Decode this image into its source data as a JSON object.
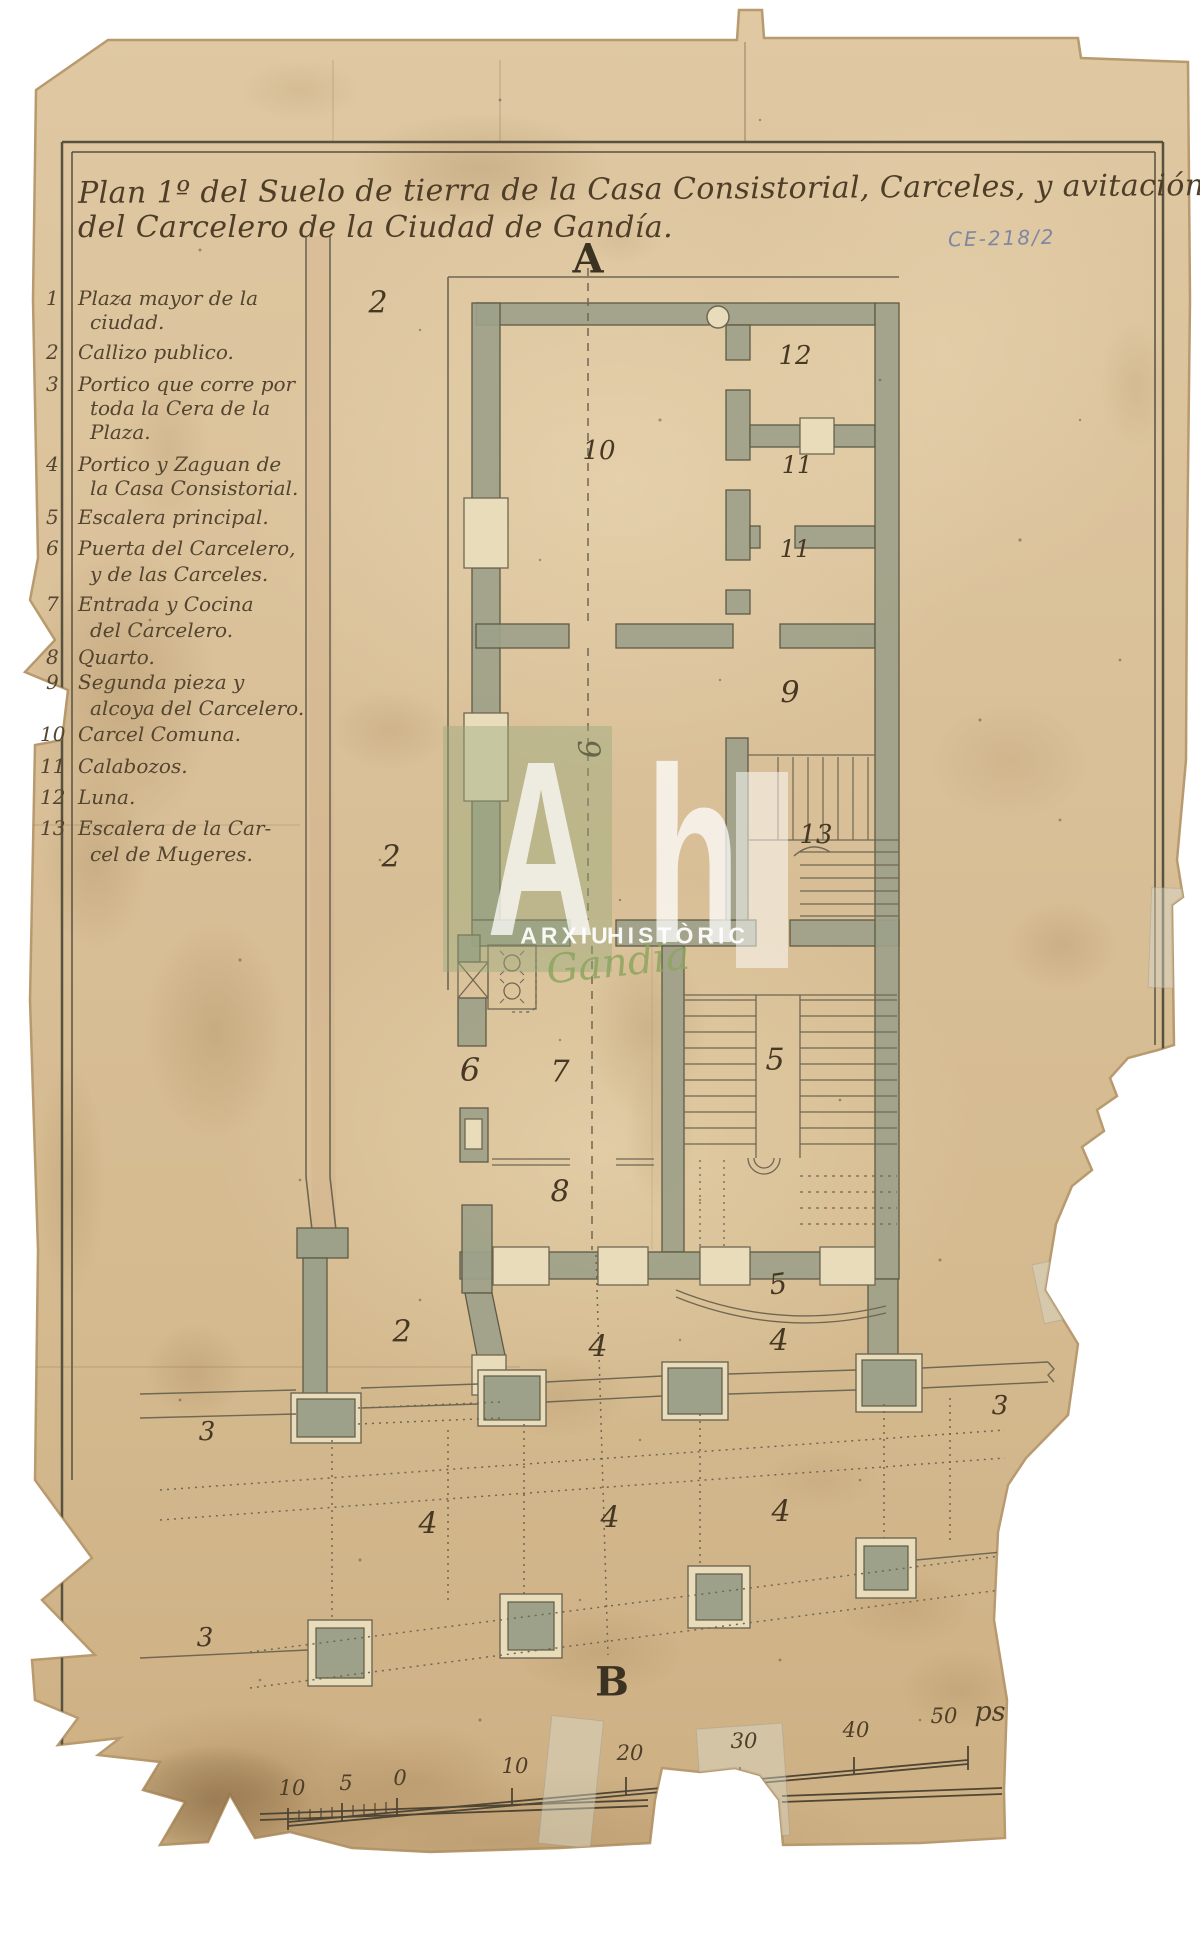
{
  "document": {
    "archive_reference": "CE-218/2",
    "title_line1": "Plan 1º del Suelo de tierra de la Casa Consistorial, Carceles, y avitación",
    "title_line2": "del Carcelero de la Ciudad de Gandía.",
    "type": "historic floor plan manuscript"
  },
  "legend": {
    "items": [
      {
        "num": "1",
        "lines": [
          {
            "text": "Plaza mayor de la",
            "y": 286
          },
          {
            "text": "ciudad.",
            "y": 310
          }
        ]
      },
      {
        "num": "2",
        "lines": [
          {
            "text": "Callizo publico.",
            "y": 340
          }
        ]
      },
      {
        "num": "3",
        "lines": [
          {
            "text": "Portico que corre por",
            "y": 372
          },
          {
            "text": "toda la Cera de la",
            "y": 396
          },
          {
            "text": "Plaza.",
            "y": 420
          }
        ]
      },
      {
        "num": "4",
        "lines": [
          {
            "text": "Portico y Zaguan de",
            "y": 452
          },
          {
            "text": "la Casa Consistorial.",
            "y": 476
          }
        ]
      },
      {
        "num": "5",
        "lines": [
          {
            "text": "Escalera principal.",
            "y": 505
          }
        ]
      },
      {
        "num": "6",
        "lines": [
          {
            "text": "Puerta del Carcelero,",
            "y": 536
          },
          {
            "text": "y de las Carceles.",
            "y": 562
          }
        ]
      },
      {
        "num": "7",
        "lines": [
          {
            "text": "Entrada y Cocina",
            "y": 592
          },
          {
            "text": "del Carcelero.",
            "y": 618
          }
        ]
      },
      {
        "num": "8",
        "lines": [
          {
            "text": "Quarto.",
            "y": 645
          }
        ]
      },
      {
        "num": "9",
        "lines": [
          {
            "text": "Segunda pieza y",
            "y": 670
          },
          {
            "text": "alcoya del Carcelero.",
            "y": 696
          }
        ]
      },
      {
        "num": "10",
        "lines": [
          {
            "text": "Carcel Comuna.",
            "y": 722
          }
        ]
      },
      {
        "num": "11",
        "lines": [
          {
            "text": "Calabozos.",
            "y": 754
          }
        ]
      },
      {
        "num": "12",
        "lines": [
          {
            "text": "Luna.",
            "y": 785
          }
        ]
      },
      {
        "num": "13",
        "lines": [
          {
            "text": "Escalera de la Car-",
            "y": 816
          },
          {
            "text": "cel de Mugeres.",
            "y": 842
          }
        ]
      }
    ]
  },
  "plan": {
    "section_marker_top": "A",
    "section_marker_bottom": "B",
    "labels": [
      {
        "text": "A",
        "x": 588,
        "y": 259,
        "size": 40,
        "rot": 0,
        "upright": true
      },
      {
        "text": "B",
        "x": 612,
        "y": 1682,
        "size": 40,
        "rot": 0,
        "upright": true
      },
      {
        "text": "2",
        "x": 378,
        "y": 303,
        "size": 30,
        "rot": 0
      },
      {
        "text": "12",
        "x": 795,
        "y": 356,
        "size": 26,
        "rot": 0
      },
      {
        "text": "10",
        "x": 599,
        "y": 451,
        "size": 26,
        "rot": 0
      },
      {
        "text": "11",
        "x": 797,
        "y": 465,
        "size": 24,
        "rot": 0
      },
      {
        "text": "11",
        "x": 795,
        "y": 549,
        "size": 24,
        "rot": 0
      },
      {
        "text": "9",
        "x": 790,
        "y": 693,
        "size": 30,
        "rot": 0
      },
      {
        "text": "9",
        "x": 588,
        "y": 749,
        "size": 30,
        "rot": 85
      },
      {
        "text": "13",
        "x": 816,
        "y": 835,
        "size": 26,
        "rot": 0
      },
      {
        "text": "2",
        "x": 391,
        "y": 857,
        "size": 30,
        "rot": 0
      },
      {
        "text": "6",
        "x": 470,
        "y": 1070,
        "size": 32,
        "rot": 0
      },
      {
        "text": "7",
        "x": 560,
        "y": 1072,
        "size": 30,
        "rot": 0
      },
      {
        "text": "8",
        "x": 560,
        "y": 1192,
        "size": 30,
        "rot": 0
      },
      {
        "text": "5",
        "x": 775,
        "y": 1060,
        "size": 30,
        "rot": 0
      },
      {
        "text": "5",
        "x": 778,
        "y": 1284,
        "size": 28,
        "rot": -8
      },
      {
        "text": "2",
        "x": 402,
        "y": 1332,
        "size": 30,
        "rot": 0
      },
      {
        "text": "4",
        "x": 598,
        "y": 1347,
        "size": 30,
        "rot": 0
      },
      {
        "text": "4",
        "x": 779,
        "y": 1341,
        "size": 30,
        "rot": 0
      },
      {
        "text": "3",
        "x": 1000,
        "y": 1406,
        "size": 26,
        "rot": 0
      },
      {
        "text": "3",
        "x": 207,
        "y": 1432,
        "size": 26,
        "rot": 0
      },
      {
        "text": "4",
        "x": 428,
        "y": 1524,
        "size": 30,
        "rot": 0
      },
      {
        "text": "4",
        "x": 610,
        "y": 1518,
        "size": 30,
        "rot": 0
      },
      {
        "text": "4",
        "x": 781,
        "y": 1512,
        "size": 30,
        "rot": 0
      },
      {
        "text": "3",
        "x": 205,
        "y": 1638,
        "size": 26,
        "rot": 0
      }
    ]
  },
  "scale_bar": {
    "unit": "ps",
    "labels": [
      {
        "text": "10",
        "x": 292,
        "y": 1788,
        "size": 21
      },
      {
        "text": "5",
        "x": 346,
        "y": 1783,
        "size": 21
      },
      {
        "text": "0",
        "x": 400,
        "y": 1778,
        "size": 21
      },
      {
        "text": "10",
        "x": 515,
        "y": 1766,
        "size": 21
      },
      {
        "text": "20",
        "x": 630,
        "y": 1753,
        "size": 21
      },
      {
        "text": "30",
        "x": 744,
        "y": 1741,
        "size": 21
      },
      {
        "text": "40",
        "x": 856,
        "y": 1730,
        "size": 21
      },
      {
        "text": "50",
        "x": 944,
        "y": 1716,
        "size": 21
      },
      {
        "text": "ps",
        "x": 990,
        "y": 1712,
        "size": 27
      }
    ]
  },
  "watermark": {
    "letter_a": "A",
    "letter_h": "h",
    "line1": "ARXIU",
    "line2": "HISTÒRIC",
    "script": "Gandia"
  },
  "colors": {
    "paper": "#d9bf97",
    "ink": "#54432c",
    "wall_fill": "#9da189",
    "pencil_ref": "#7d87a2",
    "watermark_green": "#8ca55f"
  }
}
